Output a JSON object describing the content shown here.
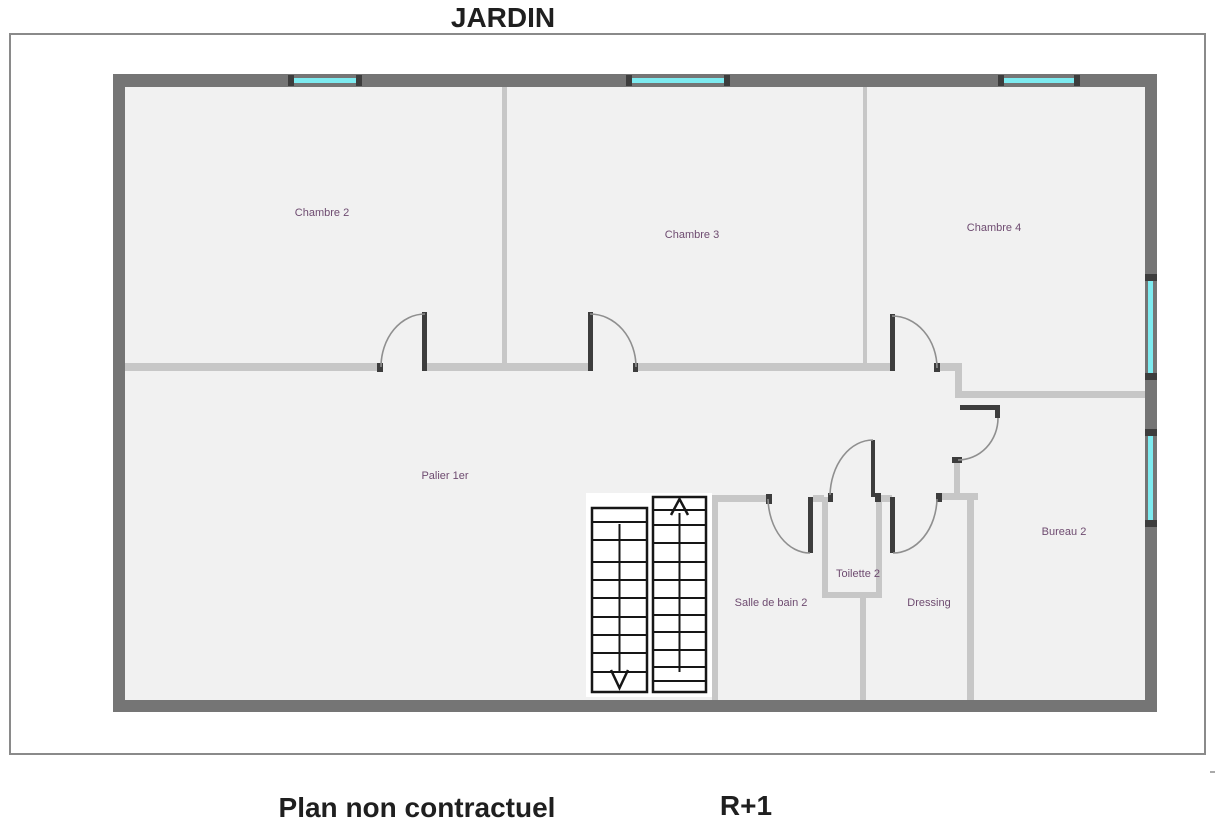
{
  "title": "JARDIN",
  "footer": {
    "left_label": "Plan non contractuel",
    "right_label": "R+1"
  },
  "rooms": [
    {
      "name": "Chambre 2"
    },
    {
      "name": "Chambre 3"
    },
    {
      "name": "Chambre 4"
    },
    {
      "name": "Palier 1er"
    },
    {
      "name": "Salle de bain 2"
    },
    {
      "name": "Toilette 2"
    },
    {
      "name": "Dressing"
    },
    {
      "name": "Bureau 2"
    }
  ],
  "colors": {
    "window": "#7debf0",
    "wall_exterior": "#757575",
    "wall_interior": "#c7c7c7",
    "floor": "#f1f1f1",
    "page_border": "#8a8a8a",
    "label": "#6e4b70"
  }
}
